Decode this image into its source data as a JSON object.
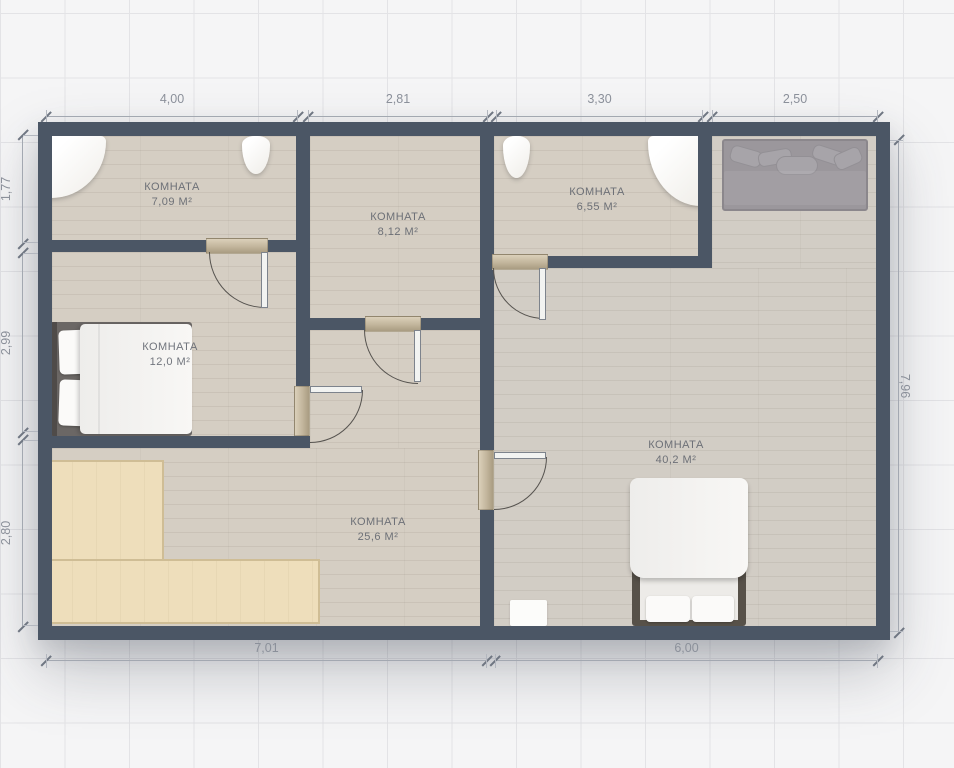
{
  "plan": {
    "rooms": [
      {
        "id": "bathroom-1",
        "label": "КОМНАТА",
        "area": "7,09 м²"
      },
      {
        "id": "hall",
        "label": "КОМНАТА",
        "area": "8,12 м²"
      },
      {
        "id": "bathroom-2",
        "label": "КОМНАТА",
        "area": "6,55 м²"
      },
      {
        "id": "bedroom",
        "label": "КОМНАТА",
        "area": "12,0 м²"
      },
      {
        "id": "living",
        "label": "КОМНАТА",
        "area": "25,6 м²"
      },
      {
        "id": "main-room",
        "label": "КОМНАТА",
        "area": "40,2 м²"
      }
    ],
    "dimensions_m": {
      "top": [
        "4,00",
        "2,81",
        "3,30",
        "2,50"
      ],
      "left": [
        "1,77",
        "2,99",
        "2,80"
      ],
      "right": [
        "7,96"
      ],
      "bottom": [
        "7,01",
        "6,00"
      ]
    },
    "colors": {
      "wall": "#4b5665",
      "floor": "#d5cec3",
      "corner_sofa": "#eedebb",
      "dimension_text": "#8b909a",
      "background_grid": "#e3e3e6"
    }
  }
}
